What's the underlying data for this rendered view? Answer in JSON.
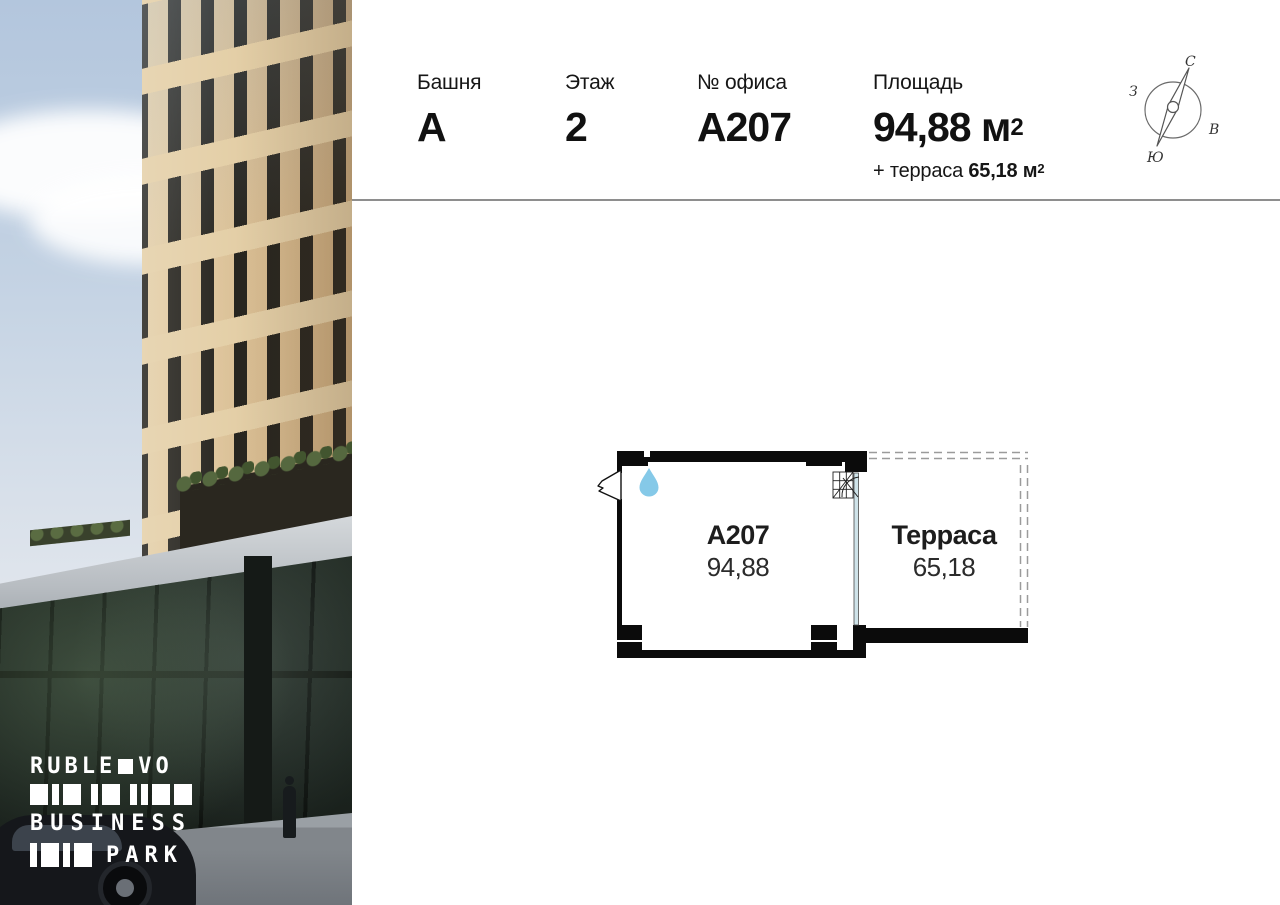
{
  "photo": {
    "description": "building-exterior-photo",
    "logo": {
      "word1": "RUBLE",
      "word2": "VO",
      "word3": "BUSINESS",
      "word4": "PARK"
    }
  },
  "header": {
    "tower": {
      "label": "Башня",
      "value": "А"
    },
    "floor": {
      "label": "Этаж",
      "value": "2"
    },
    "office": {
      "label": "№ офиса",
      "value": "А207"
    },
    "area": {
      "label": "Площадь",
      "value": "94,88",
      "unit": " м",
      "sup": "2",
      "terrace_prefix": "+ терраса ",
      "terrace_value": "65,18",
      "terrace_unit": " м",
      "terrace_sup": "2"
    }
  },
  "compass": {
    "north": "С",
    "east": "В",
    "south": "Ю",
    "west": "З"
  },
  "floorplan": {
    "room": {
      "label": "А207",
      "area": "94,88"
    },
    "terrace": {
      "label": "Терраса",
      "area": "65,18"
    },
    "colors": {
      "wall": "#0b0b0b",
      "glass": "#cfe3e9",
      "drop": "#85c9e8",
      "dash": "#9b9b9b"
    }
  }
}
